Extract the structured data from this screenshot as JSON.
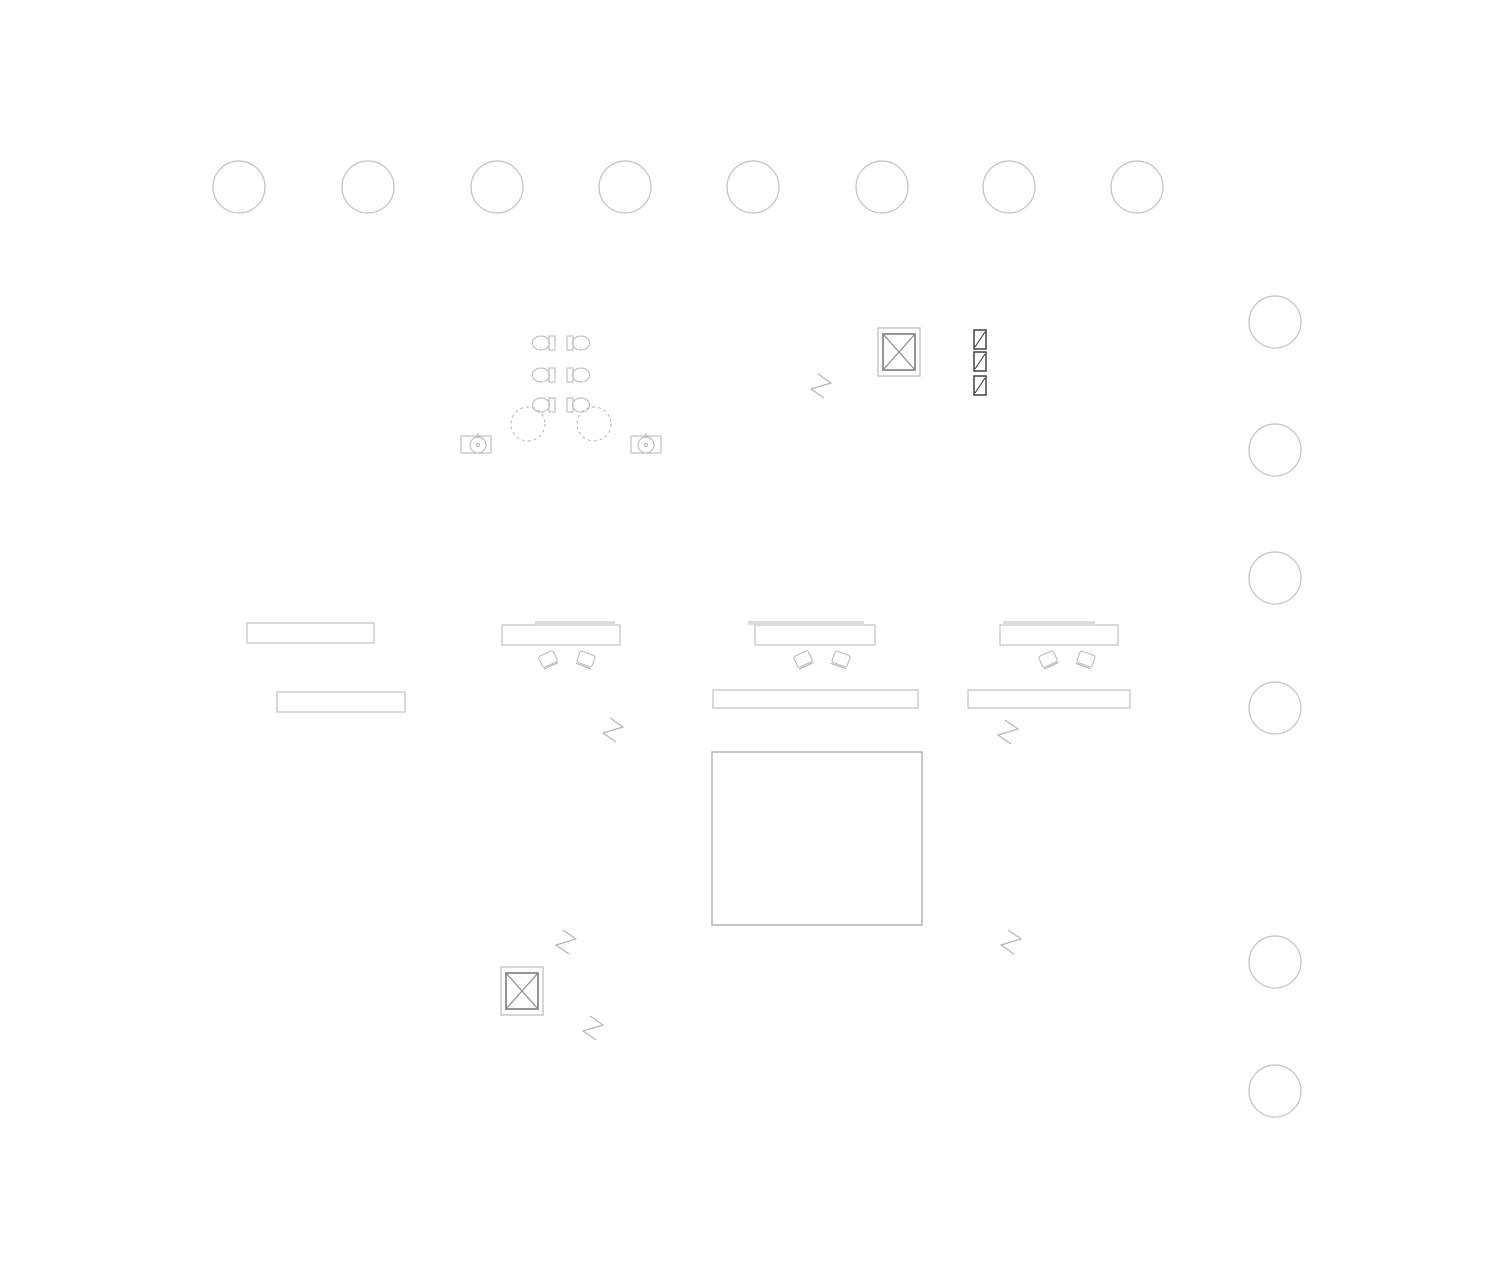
{
  "drawing": {
    "type": "architectural-floor-plan",
    "grid": {
      "columns": [
        "A",
        "B",
        "C",
        "D",
        "E",
        "F",
        "G",
        "H"
      ],
      "rows": [
        "1",
        "2",
        "3",
        "4",
        "5",
        "6"
      ]
    }
  },
  "colors": {
    "background": "#ffffff",
    "wall": "#0b0b0b",
    "bubble_stroke": "#bdbdbd",
    "label_ink": "#222222",
    "leader_dash": "#c2c2c2",
    "fine_line": "#cfcfcf",
    "mid_line": "#b0b0b0",
    "door_arc": "#9c9c9c",
    "window_fill": "#dcdcdc"
  }
}
